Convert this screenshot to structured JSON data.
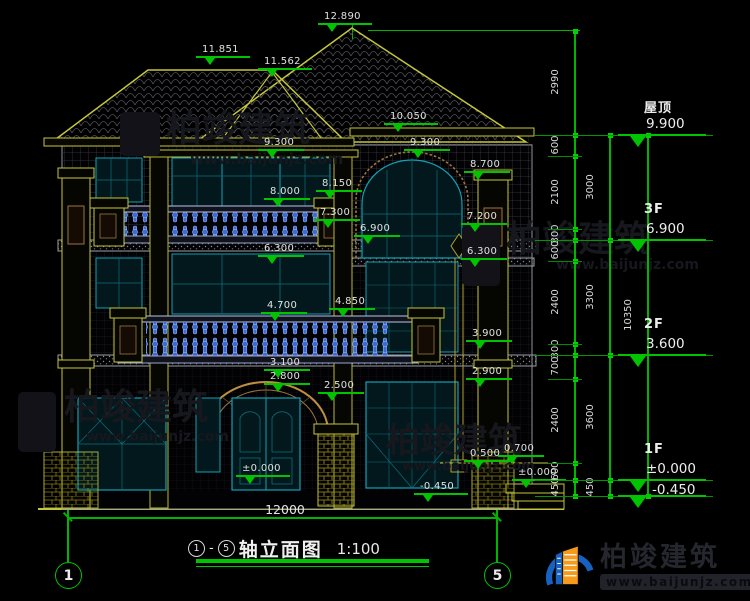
{
  "drawing": {
    "watermark": {
      "brand": "柏竣建筑",
      "site": "www.baijunjz.com"
    },
    "annotations": {
      "markers": [
        {
          "value": "12.890",
          "x": 318,
          "y": 24
        },
        {
          "value": "11.851",
          "x": 196,
          "y": 57
        },
        {
          "value": "11.562",
          "x": 258,
          "y": 69
        },
        {
          "value": "10.050",
          "x": 384,
          "y": 124
        },
        {
          "value": "9.300",
          "x": 258,
          "y": 150
        },
        {
          "value": "9.300",
          "x": 404,
          "y": 150
        },
        {
          "value": "8.700",
          "x": 464,
          "y": 172
        },
        {
          "value": "8.150",
          "x": 316,
          "y": 191
        },
        {
          "value": "8.000",
          "x": 264,
          "y": 199
        },
        {
          "value": "7.300",
          "x": 314,
          "y": 220
        },
        {
          "value": "7.200",
          "x": 461,
          "y": 224
        },
        {
          "value": "6.900",
          "x": 354,
          "y": 236
        },
        {
          "value": "6.300",
          "x": 258,
          "y": 256
        },
        {
          "value": "6.300",
          "x": 461,
          "y": 259
        },
        {
          "value": "4.850",
          "x": 329,
          "y": 309
        },
        {
          "value": "4.700",
          "x": 261,
          "y": 313
        },
        {
          "value": "3.900",
          "x": 466,
          "y": 341
        },
        {
          "value": "3.100",
          "x": 264,
          "y": 370
        },
        {
          "value": "2.900",
          "x": 466,
          "y": 379
        },
        {
          "value": "2.800",
          "x": 264,
          "y": 384
        },
        {
          "value": "2.500",
          "x": 318,
          "y": 393
        },
        {
          "value": "0.700",
          "x": 498,
          "y": 456
        },
        {
          "value": "0.500",
          "x": 464,
          "y": 461
        },
        {
          "value": "±0.000",
          "x": 236,
          "y": 476
        },
        {
          "value": "±0.000",
          "x": 512,
          "y": 480
        },
        {
          "value": "-0.450",
          "x": 414,
          "y": 494
        }
      ]
    },
    "dims": {
      "inner": {
        "x": 575,
        "bounds": [
          31,
          135,
          156,
          229,
          240,
          261,
          344,
          355,
          379,
          463,
          480,
          496
        ],
        "labels": [
          "2990",
          "600",
          "2100",
          "300",
          "600",
          "2400",
          "300",
          "700",
          "2400",
          "600",
          "450"
        ]
      },
      "middle": {
        "x": 610,
        "bounds": [
          135,
          240,
          355,
          480,
          496
        ],
        "labels": [
          "3000",
          "3300",
          "3600",
          "450"
        ]
      },
      "outer": {
        "x": 648,
        "bounds": [
          135,
          496
        ],
        "labels": [
          "10350"
        ]
      },
      "bottom": {
        "label": "12000"
      }
    },
    "levels": [
      {
        "name": "屋顶",
        "value": "9.900",
        "y": 135
      },
      {
        "name": "3F",
        "value": "6.900",
        "y": 240
      },
      {
        "name": "2F",
        "value": "3.600",
        "y": 355
      },
      {
        "name": "1F",
        "value": "±0.000",
        "y": 480
      },
      {
        "name": "",
        "value": "-0.450",
        "y": 496
      }
    ],
    "axis_bubbles": {
      "left": "1",
      "right": "5"
    }
  },
  "title_bar": {
    "axis_from": "1",
    "axis_to": "5",
    "name": "轴立面图",
    "scale": "1:100"
  },
  "logo": {
    "brand": "柏竣建筑",
    "site": "www.baijunjz.com"
  }
}
